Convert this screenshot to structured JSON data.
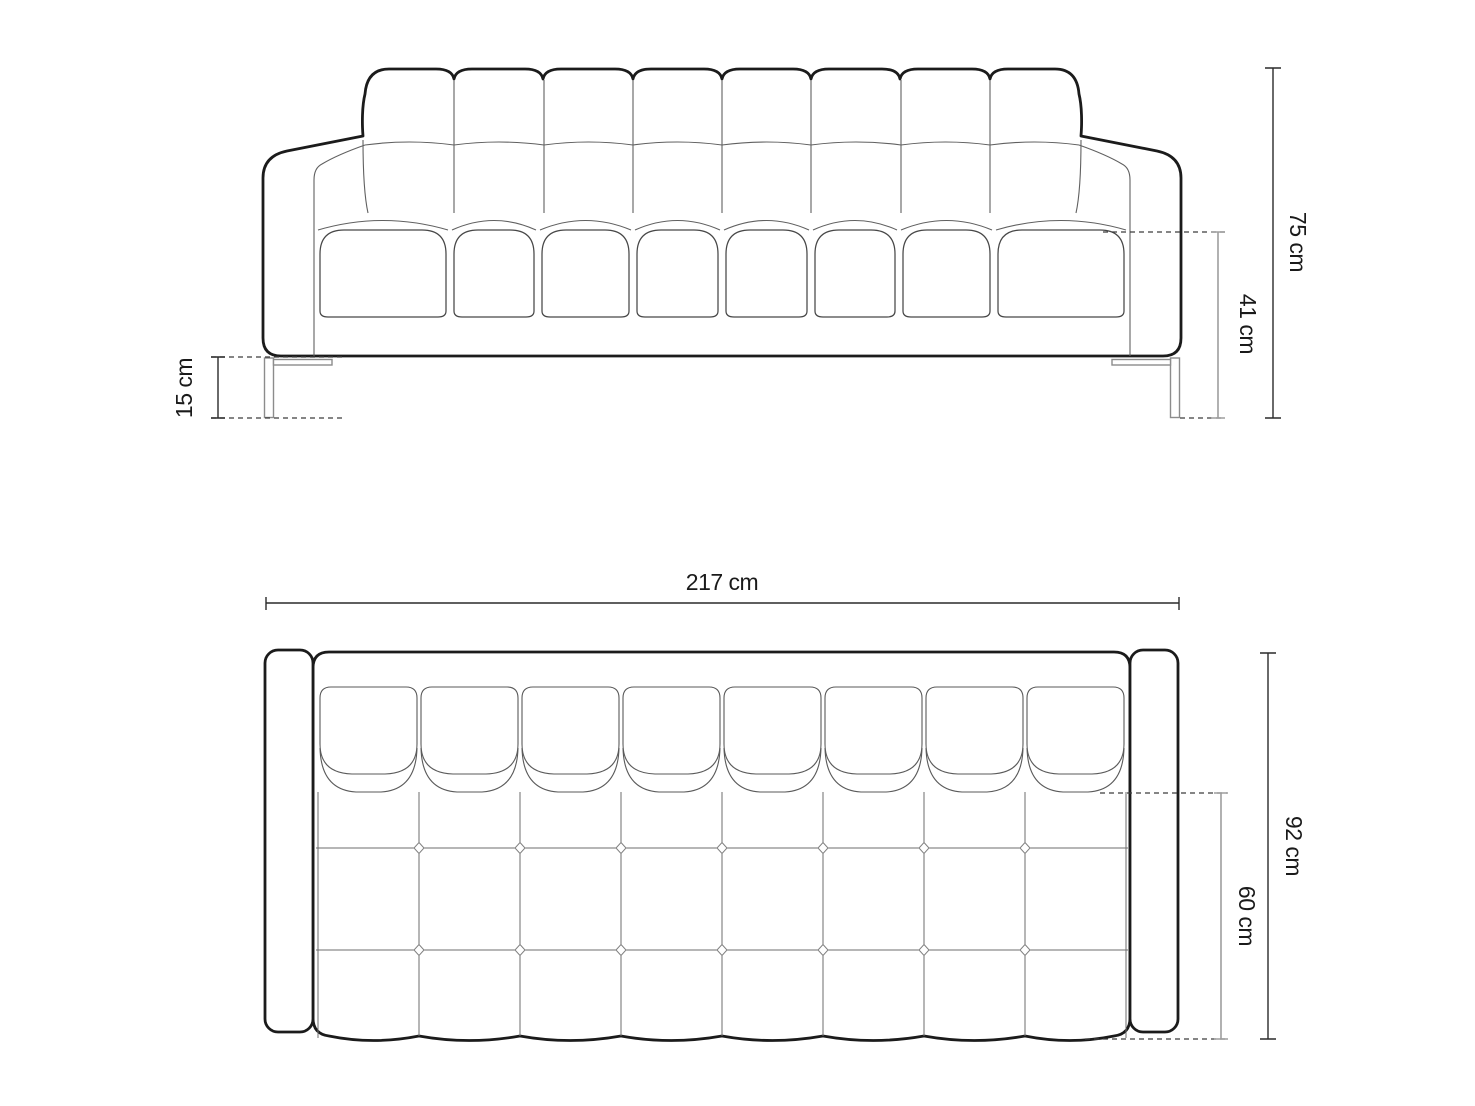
{
  "page": {
    "background": "#ffffff"
  },
  "unit": "cm",
  "dims": {
    "height": {
      "label": "75 cm",
      "value": 75,
      "unit": "cm",
      "view": "front",
      "meaning": "total height"
    },
    "seat_height": {
      "label": "41 cm",
      "value": 41,
      "unit": "cm",
      "view": "front",
      "meaning": "seat height"
    },
    "leg_height": {
      "label": "15 cm",
      "value": 15,
      "unit": "cm",
      "view": "front",
      "meaning": "leg height"
    },
    "width": {
      "label": "217 cm",
      "value": 217,
      "unit": "cm",
      "view": "top",
      "meaning": "total width"
    },
    "depth": {
      "label": "92 cm",
      "value": 92,
      "unit": "cm",
      "view": "top",
      "meaning": "total depth"
    },
    "seat_depth": {
      "label": "60 cm",
      "value": 60,
      "unit": "cm",
      "view": "top",
      "meaning": "seat depth"
    }
  },
  "counts": {
    "back_cushions": 8,
    "seat_cushions": 8,
    "plan_back_cushions": 8,
    "plan_seam_rows": 2,
    "legs": 2
  },
  "colors": {
    "outline": "#1b1b1b",
    "detail": "#606060",
    "dimension_dark": "#2a2a2a",
    "dimension_gray": "#9e9e9e",
    "dashed": "#3c3c3c",
    "leg_gray": "#8c8c8c",
    "text": "#1a1a1a",
    "background": "#ffffff"
  }
}
